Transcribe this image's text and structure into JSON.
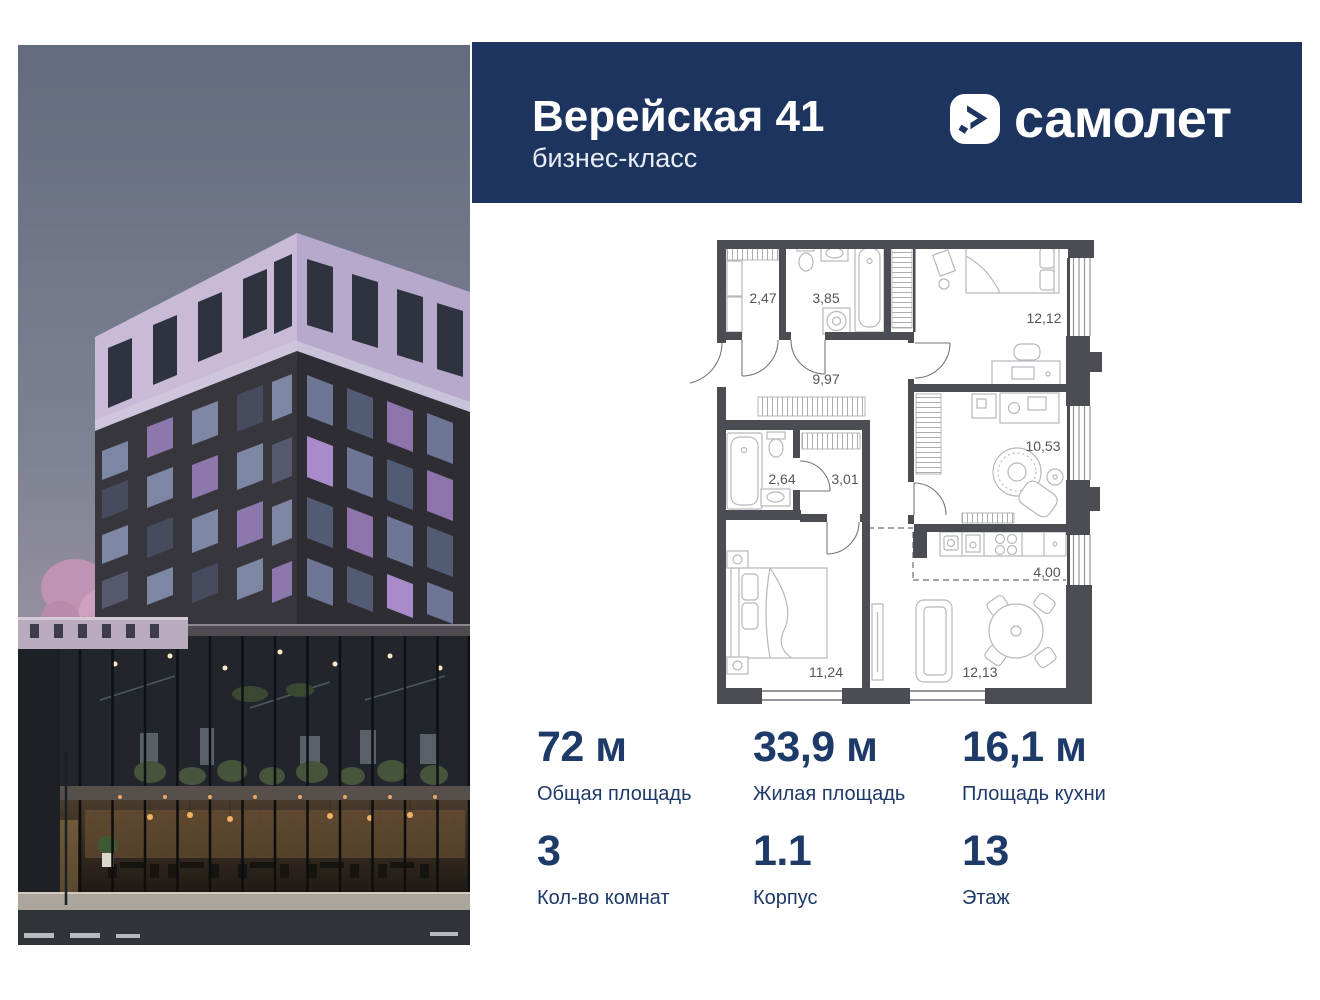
{
  "header": {
    "title": "Верейская 41",
    "subtitle": "бизнес-класс",
    "brand": "самолет"
  },
  "floor_plan": {
    "areas": {
      "wardrobe_entry": "2,47",
      "bathroom": "3,85",
      "bedroom_top": "12,12",
      "hallway": "9,97",
      "bath_small": "2,64",
      "storage": "3,01",
      "room_middle": "10,53",
      "kitchen": "4,00",
      "bedroom_main": "11,24",
      "living": "12,13"
    }
  },
  "stats": {
    "items": [
      {
        "value": "72 м",
        "label": "Общая площадь"
      },
      {
        "value": "33,9 м",
        "label": "Жилая площадь"
      },
      {
        "value": "16,1 м",
        "label": "Площадь кухни"
      },
      {
        "value": "3",
        "label": "Кол-во комнат"
      },
      {
        "value": "1.1",
        "label": "Корпус"
      },
      {
        "value": "13",
        "label": "Этаж"
      }
    ]
  },
  "colors": {
    "header_bg": "#1d345f",
    "stat_text": "#1e3a69",
    "plan_wall": "#4c4d54",
    "plan_label": "#54555a"
  }
}
